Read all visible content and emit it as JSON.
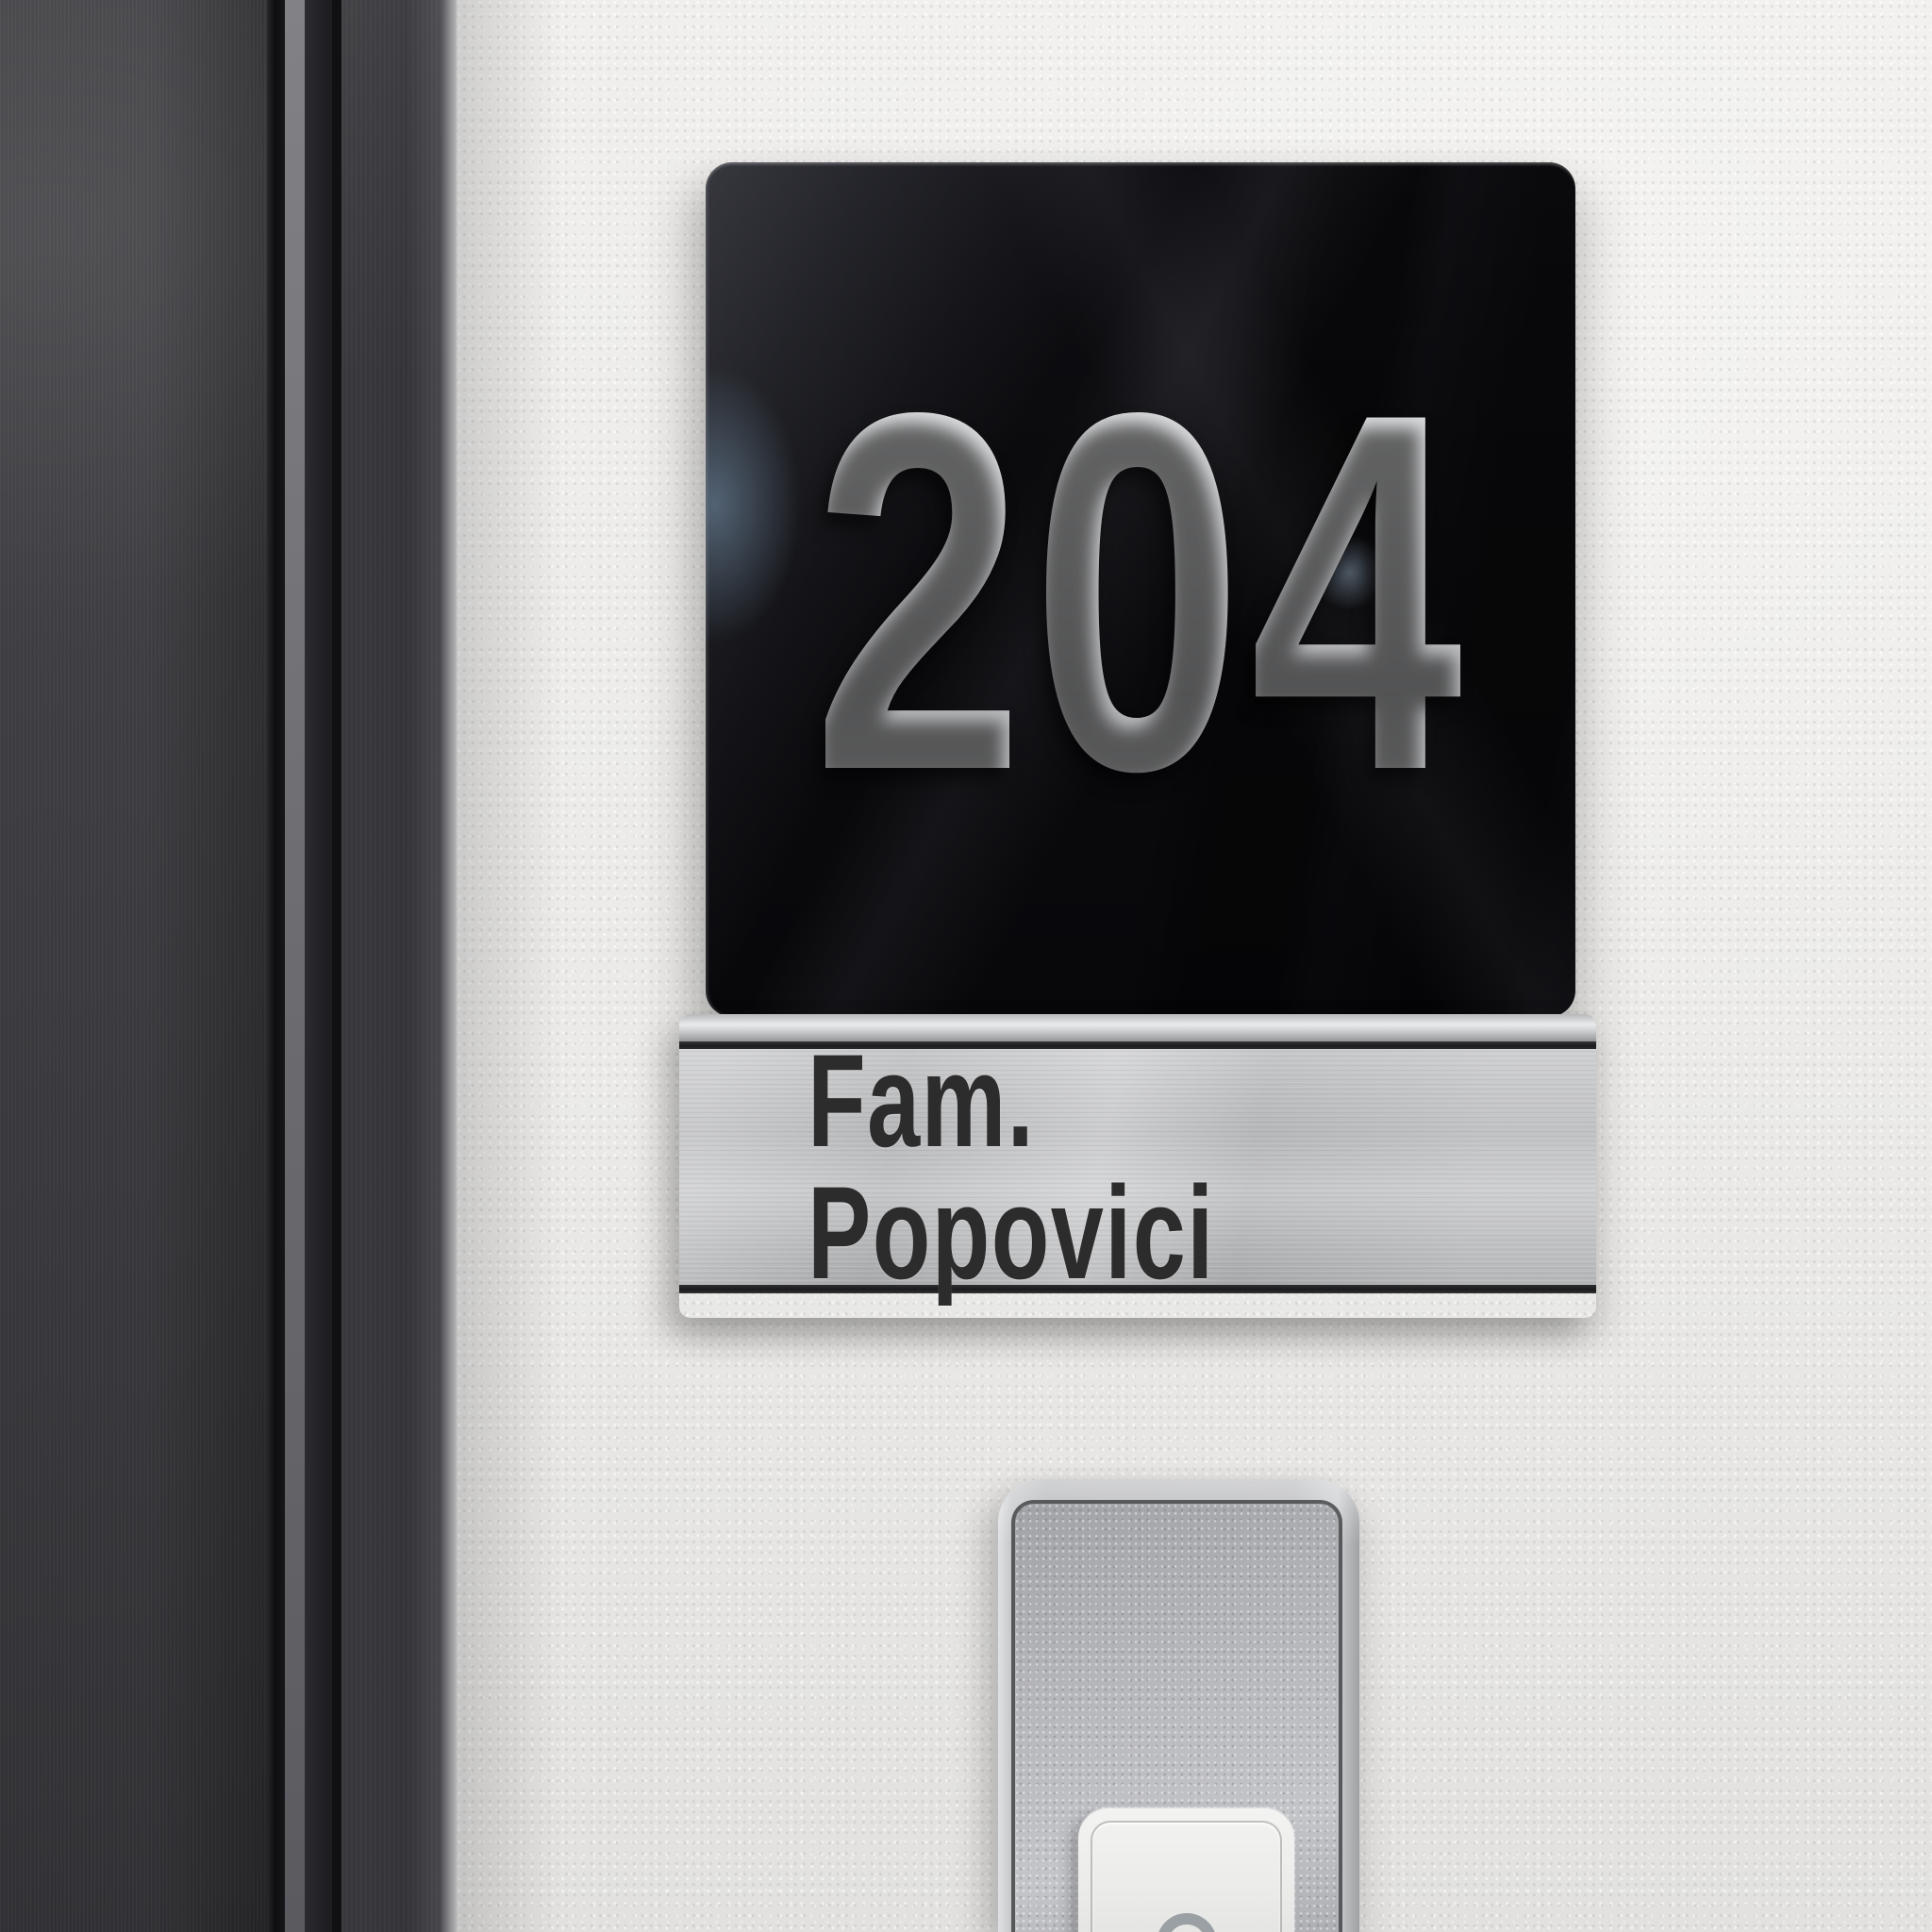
{
  "sign": {
    "room_number": "204",
    "plate_color": "#0a0a0d",
    "number_color": "#c9cacc",
    "material": "glossy-black-acrylic"
  },
  "nameplate": {
    "text": "Fam. Popovici",
    "plate_color": "#bcbdbf",
    "text_color": "#2c2c2c",
    "material": "brushed-stainless-steel"
  },
  "doorbell": {
    "icon": "bell-icon",
    "frame_color": "#b5b6b9",
    "plate_color": "#b3b4b8",
    "button_color": "#ececea",
    "icon_color": "#9aa0a4"
  },
  "environment": {
    "wall_color": "#edecea",
    "door_color": "#3c3c40"
  }
}
